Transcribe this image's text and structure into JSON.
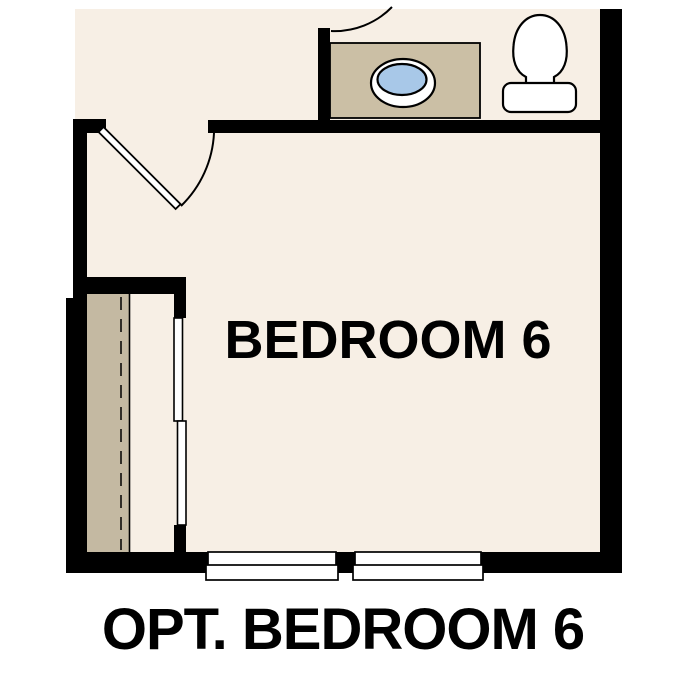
{
  "labels": {
    "room": "BEDROOM 6",
    "caption": "OPT. BEDROOM 6"
  },
  "colors": {
    "background": "#ffffff",
    "floor": "#f7efe5",
    "wall": "#000000",
    "line": "#000000",
    "text": "#000000",
    "vanity": "#cbbfa5",
    "shelf": "#c4b9a2",
    "sink": "#a8c8e8"
  }
}
